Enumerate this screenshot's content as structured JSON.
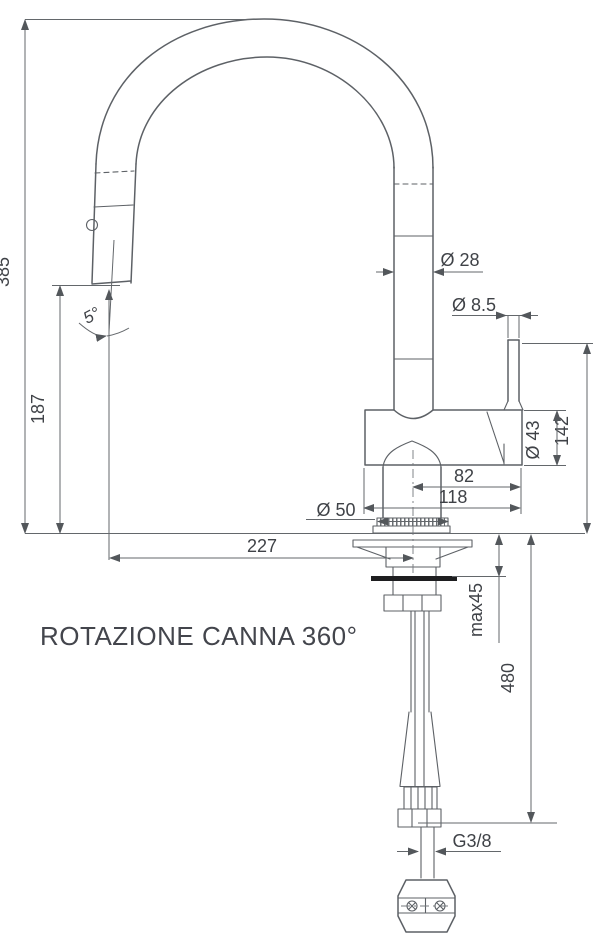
{
  "colors": {
    "line": "#5d6166",
    "text": "#3f4247",
    "background": "#ffffff",
    "gasket": "#1e1e20"
  },
  "labels": {
    "total_height": "385",
    "outlet_height": "187",
    "spout_reach": "227",
    "swivel_angle": "5°",
    "spout_diameter": "Ø 28",
    "lever_diameter": "Ø 8.5",
    "body_diameter": "Ø 43",
    "lever_height": "142",
    "lever_offset": "82",
    "body_length": "118",
    "base_diameter": "Ø 50",
    "max_counter_thickness": "max45",
    "hose_length": "480",
    "connection_thread": "G3/8",
    "note_rotation": "ROTAZIONE CANNA 360°"
  }
}
